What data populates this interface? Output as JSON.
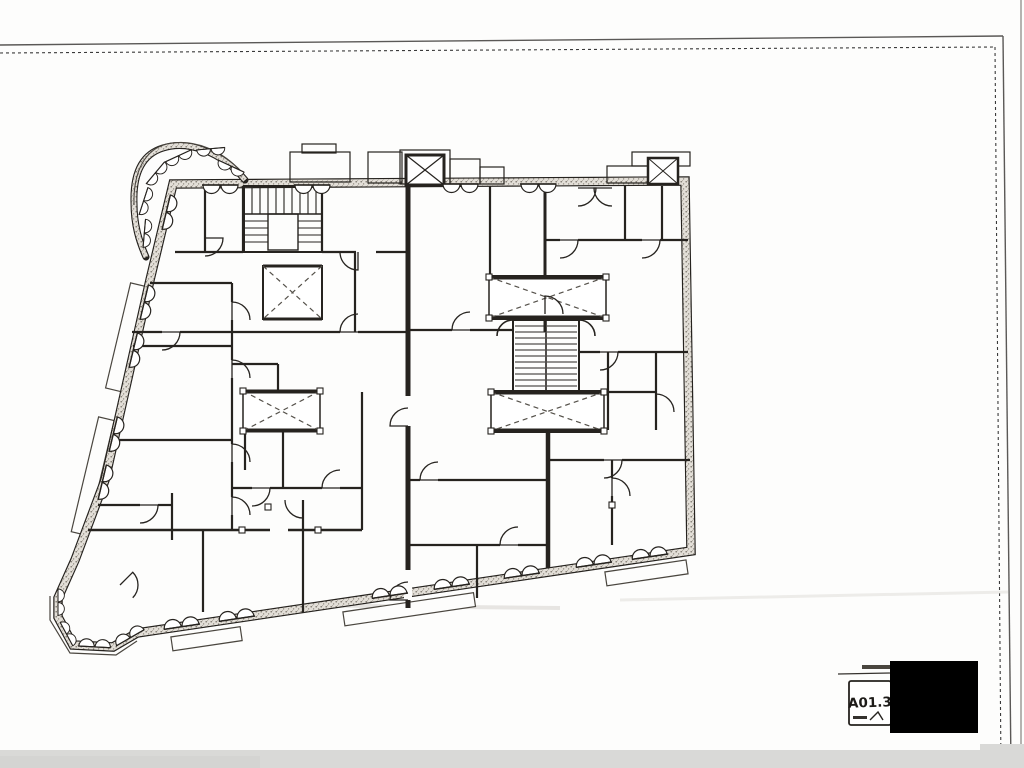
{
  "document": {
    "kind": "scanned architectural floor plan sheet",
    "sheet_number": "A01.3",
    "colors": {
      "ink": "#26231f",
      "paper": "#fdfdfc",
      "wall_fill": "#e3dfd8",
      "scan_band": "#d9d9d7",
      "redaction": "#000000"
    },
    "plan_features": {
      "exterior_wall": "hatched masonry wall",
      "corner_turret": "rounded corner bay with casement windows",
      "bottom_left_bay": "octagonal corner bay",
      "stair_cores": "u-stair top-left, double-run stair center",
      "elevator_shafts": "crossed shaft boxes on roof line",
      "light_wells": "four dashed-cross light wells",
      "balconies": "exterior balcony slabs",
      "windows": "double-leaf casement symbols",
      "doors": "quarter-circle door swings"
    }
  }
}
